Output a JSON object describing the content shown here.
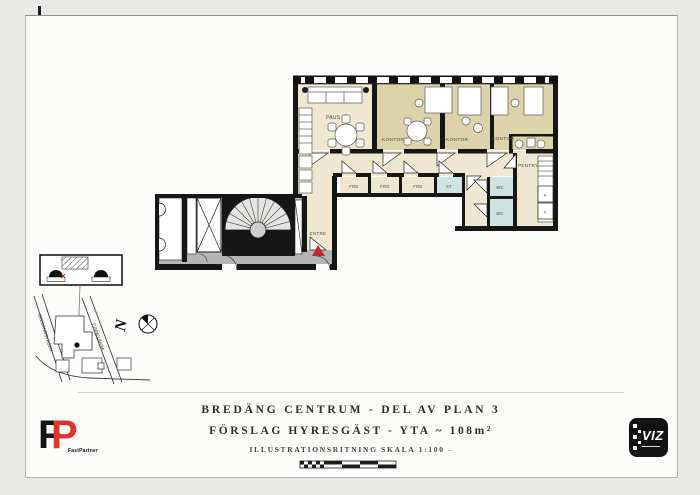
{
  "title_block": {
    "line1": "BREDÄNG CENTRUM - DEL AV PLAN 3",
    "line2": "FÖRSLAG HYRESGÄST - YTA ~ 108m²",
    "line3": "ILLUSTRATIONSRITNING SKALA 1:100 -"
  },
  "plan": {
    "labels": {
      "paus": "PAUS",
      "kontor": "KONTOR",
      "frd": "FRD",
      "st": "ST",
      "wc": "WC",
      "pentry": "PENTRY",
      "entre": "ENTRE",
      "k": "K",
      "f": "F"
    },
    "colors": {
      "room_cream": "#f0e7d2",
      "room_khaki": "#ddd3ab",
      "wet_blue": "#cfe4e0",
      "common_gray": "#b5b5b4",
      "wall": "#161616",
      "entry_red": "#c1272d"
    }
  },
  "site_map": {
    "street1": "BREDÄNGSVÄGEN",
    "street2": "TUNNELBANA",
    "north": "N"
  },
  "logos": {
    "fastpartner": {
      "letter_f": "F",
      "letter_p": "P",
      "name": "FastPartner"
    },
    "viz": {
      "label": "VIZ"
    }
  }
}
